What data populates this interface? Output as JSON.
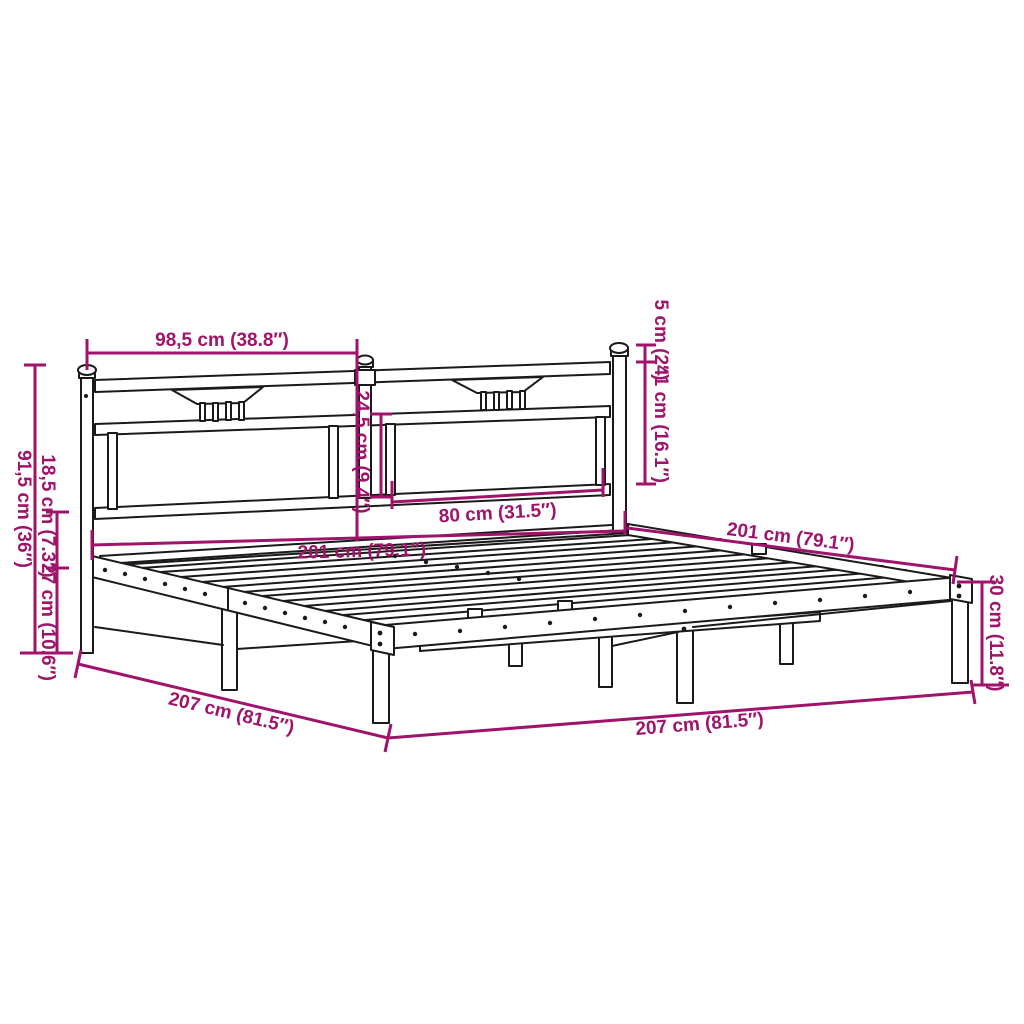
{
  "title": "Metal bed frame with headboard — dimension diagram",
  "colors": {
    "dimension": "#A0136B",
    "line": "#1A1A1A",
    "background": "#FFFFFF"
  },
  "dimensions": {
    "headboard_section_width": "98,5 cm (38.8″)",
    "headboard_total_height": "91,5 cm (36″)",
    "lower_rail_gap": "18,5 cm (7.3″)",
    "underbed_clearance": "27 cm (10.6″)",
    "panel_height": "24,5 cm (9.4″)",
    "panel_width": "80 cm (31.5″)",
    "post_cap_gap": "5 cm (2″)",
    "headboard_upper_height": "41 cm (16.1″)",
    "inner_width": "201 cm (79.1″)",
    "inner_length": "201 cm (79.1″)",
    "platform_height": "30 cm (11.8″)",
    "outer_length": "207 cm (81.5″)",
    "outer_width": "207 cm (81.5″)"
  }
}
